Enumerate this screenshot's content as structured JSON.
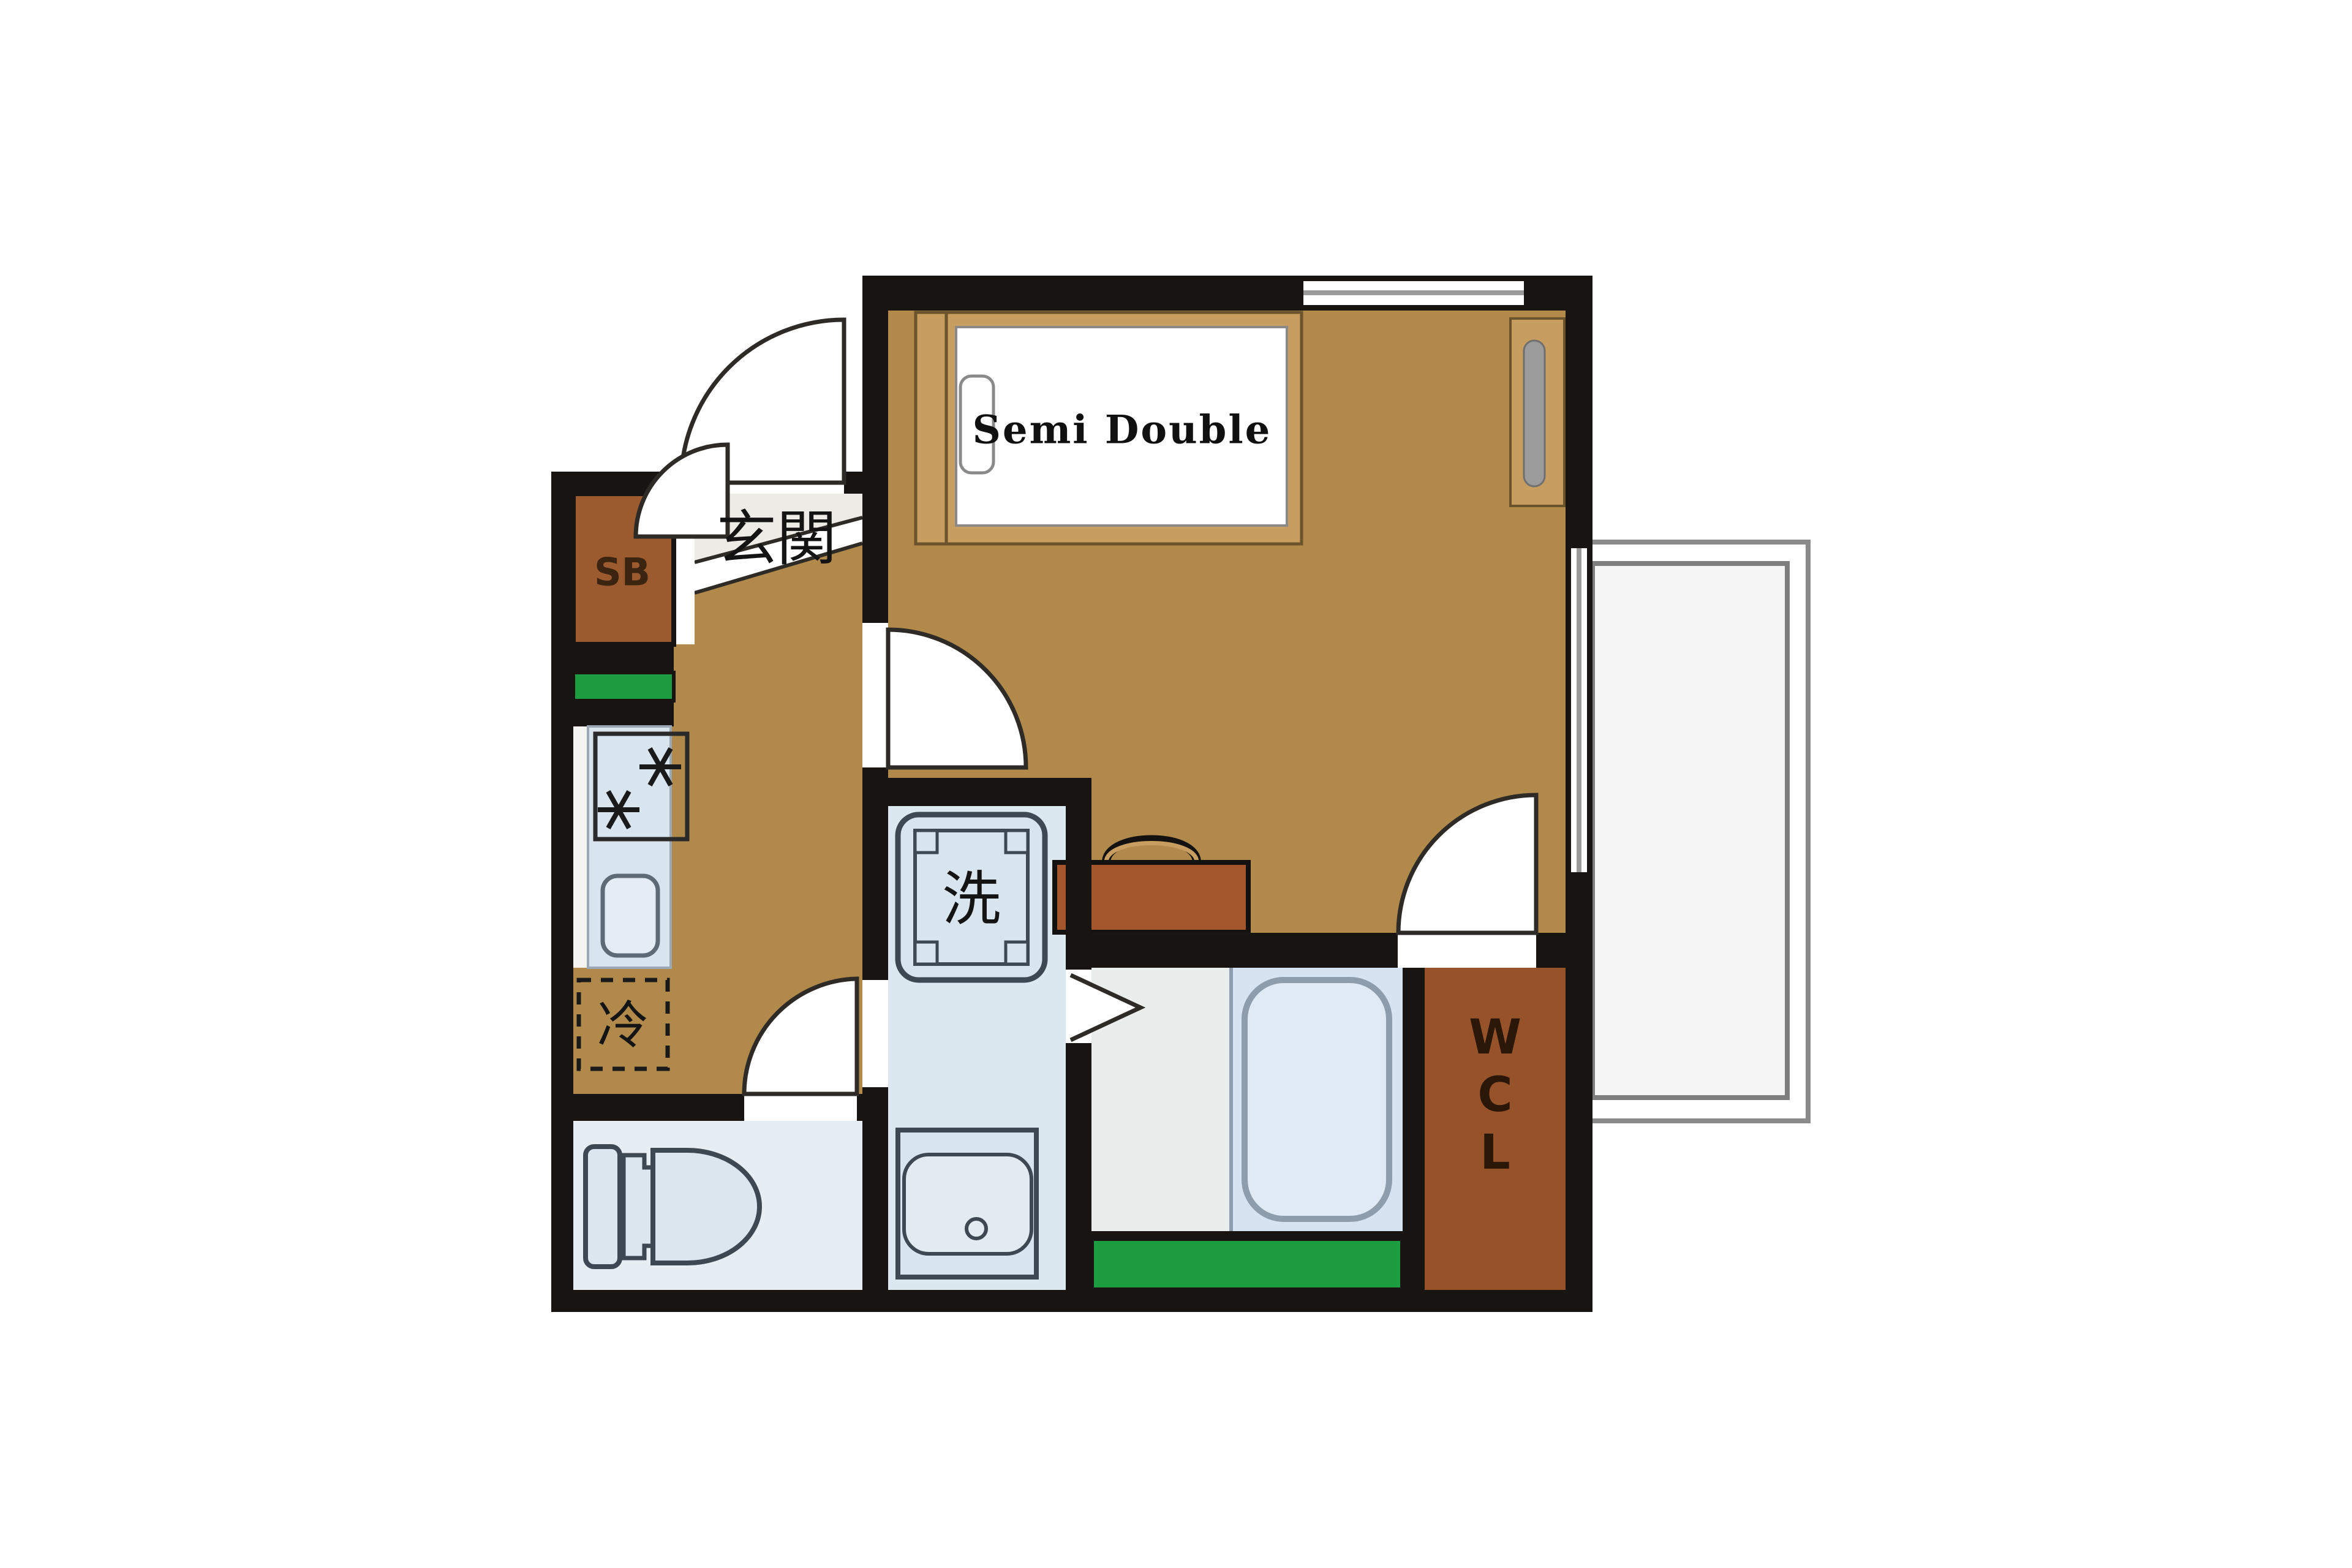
{
  "title": "Japanese apartment floor plan",
  "labels": {
    "bed": "Semi Double",
    "entrance": "玄関",
    "shoe_box": "SB",
    "washing_machine": "洗",
    "refrigerator": "冷",
    "walk_in_closet": [
      "W",
      "C",
      "L"
    ]
  },
  "colors": {
    "wall": "#171411",
    "floor_tan": "#B1894B",
    "genkan_floor": "#ECEBE6",
    "step_band": "#FFFFFF",
    "bed_frame": "#C79E60",
    "mattress": "#FFFFFF",
    "shoe_box_brown": "#9C5A2F",
    "wcl_brown": "#96532A",
    "luggage_brown": "#A3552C",
    "accent_green": "#1D9C42",
    "counter_blue": "#D8E4EE",
    "washroom_floor": "#DCE8F0",
    "toilet_floor": "#E7EEF3",
    "bath_floor_left": "#E9EDEC",
    "bath_floor_right": "#D6E3F1",
    "tub_fill": "#E0EAF4",
    "balcony_gray": "#F5F5F5",
    "fixture_stroke": "#3D4852",
    "cabinet_handle_gray": "#9B9B9B"
  },
  "icons": {
    "bed": "rectangle with mattress and pillow",
    "wardrobe-panel": "tall cabinet with capsule handle",
    "luggage": "suitcase with handle",
    "stove": "two asterisk burners in square",
    "kitchen-sink": "rounded rectangle",
    "refrigerator": "dashed square",
    "washing-machine": "notched square pan",
    "wash-basin": "square pan with drain",
    "toilet": "tank and bowl",
    "bathtub": "rounded capsule",
    "hinged-door": "quarter-circle swing arc",
    "folding-door": "chevron",
    "window": "double line gap in wall",
    "balcony": "double outlined rectangle"
  }
}
